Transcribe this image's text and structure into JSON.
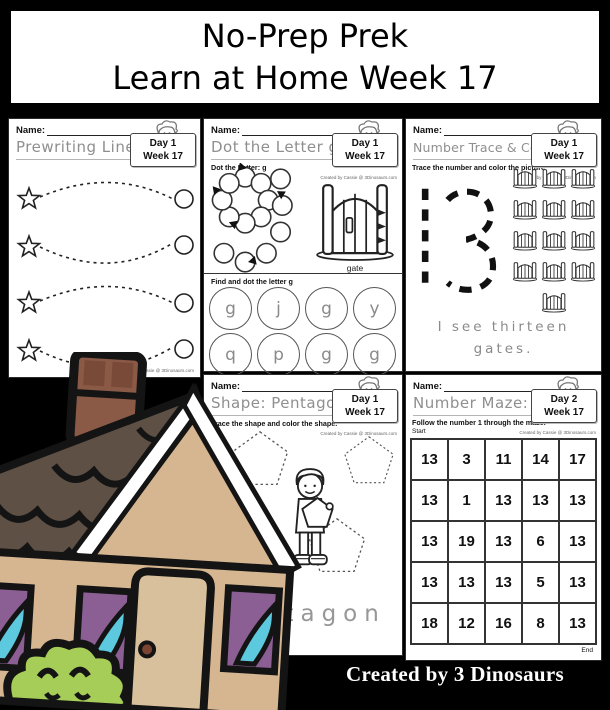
{
  "banner": {
    "line1": "No-Prep Prek",
    "line2": "Learn at Home Week 17"
  },
  "footer": {
    "credit": "Created by 3 Dinosaurs"
  },
  "common": {
    "name_label": "Name:",
    "credit_small": "Created by Cassie @ 3Dinosaurs.com"
  },
  "worksheets": {
    "prewriting": {
      "title": "Prewriting Lines",
      "day": "Day 1",
      "week": "Week 17"
    },
    "dot_letter": {
      "title": "Dot the Letter g",
      "day": "Day 1",
      "week": "Week 17",
      "instruction": "Dot the Letter: g",
      "image_label": "gate",
      "find_instruction": "Find and dot the letter g",
      "letters": [
        "g",
        "j",
        "g",
        "y",
        "q",
        "p",
        "g",
        "g"
      ]
    },
    "number_trace": {
      "title": "Number Trace & Color: 13",
      "day": "Day 1",
      "week": "Week 17",
      "instruction": "Trace the number and color the picture",
      "number": "13",
      "gate_count": 13,
      "sentence_line1": "I see thirteen",
      "sentence_line2": "gates."
    },
    "shape": {
      "title": "Shape: Pentagon",
      "day": "Day 1",
      "week": "Week 17",
      "instruction": "Trace the shape and color the shape.",
      "trace_word": "pentagon"
    },
    "maze": {
      "title": "Number Maze: 13",
      "day": "Day 2",
      "week": "Week 17",
      "instruction": "Follow the number 1 through the maze.",
      "start_label": "Start",
      "end_label": "End",
      "grid": [
        [
          13,
          3,
          11,
          14,
          17
        ],
        [
          13,
          1,
          13,
          13,
          13
        ],
        [
          13,
          19,
          13,
          6,
          13
        ],
        [
          13,
          13,
          13,
          5,
          13
        ],
        [
          18,
          12,
          16,
          8,
          13
        ]
      ]
    }
  },
  "colors": {
    "background": "#000000",
    "banner_bg": "#ffffff",
    "banner_text": "#000000",
    "roof_brown": "#5e5044",
    "wall_tan": "#d6b690",
    "door_tan": "#d9c09c",
    "chimney_brown": "#8a5a46",
    "brick_dark": "#7a4a38",
    "knob_brown": "#7a4433",
    "curtain_purple": "#8b5f94",
    "window_cyan": "#5cc9de",
    "bush_green": "#a6cd58",
    "outline_black": "#141414",
    "trace_gray": "#8f8f8f",
    "footer_text": "#ffffff"
  }
}
